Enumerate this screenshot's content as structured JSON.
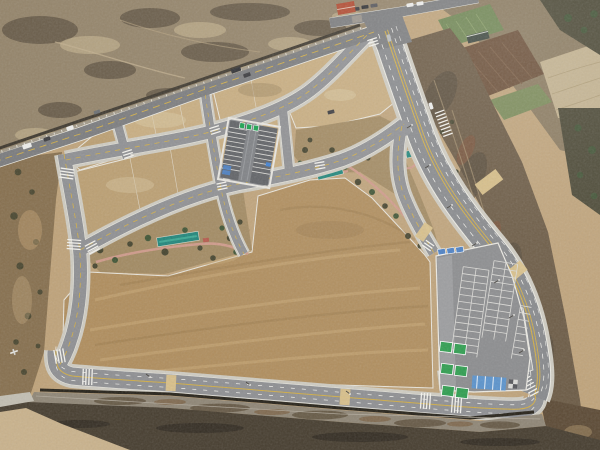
{
  "scene": {
    "description": "Winter aerial drone photo of a newly graded land-development district: bare tan earth lots outlined by fresh concrete-gray roads, a central sunken parking bay, a large surface parking lot with green EV stalls and blue accessible stalls, linear pocket parks with pink walking paths and teal shade structures, an existing boundary road with traffic at upper left, farm fields and wooded slopes at upper right, and a dark rock-faced retaining wall along the bottom edge.",
    "palette": {
      "base": "#bfa37a",
      "lotLight": "#c8ad80",
      "lotMid": "#bb9f72",
      "bigLot": "#b08e5e",
      "streakLight": "#dbbd8a",
      "streakDark": "#8a6b40",
      "scrubNW": "#94846a",
      "scrubSW": "#87704f",
      "scrubDark": "#554939",
      "scrubLight": "#cbb992",
      "slopeEast": "#6b5a44",
      "slopeRed": "#7d5238",
      "slopeLight": "#a5906e",
      "woods": "#4a4734",
      "treeDark": "#45442e",
      "treeGreen": "#3f5434",
      "fieldGreen": "#6f8653",
      "fieldBrown": "#6b4f38",
      "fieldPale": "#c2b18e",
      "fieldStripe": "#7a8a58",
      "roadNew": "#8f9093",
      "roadOld": "#7b7c7e",
      "roadArterial": "#87898c",
      "sidewalk": "#cfccc2",
      "rimWhite": "#ecebe4",
      "curb": "#e9e6dd",
      "lineWhite": "#f4f3ee",
      "lineYellow": "#d2ae46",
      "paverTan": "#dcc28b",
      "parkGround": "#a28a62",
      "pathPink": "#cf9a8a",
      "teal": "#1f857a",
      "tealLight": "#39a893",
      "p1Asphalt": "#5f6165",
      "p1Aisle": "#7e8084",
      "stallWhite": "#dcdbd7",
      "signGreen": "#17a04c",
      "signBlue": "#3f7fd0",
      "hcBlue": "#4a7fc4",
      "evGreen": "#2f9e50",
      "blueStripe": "#5b93cc",
      "p2Asphalt": "#8b8c8e",
      "p2Aisle": "#9b9c9e",
      "gabion": "#8f8676",
      "wallDark": "#473e30",
      "wallShadow": "#262219",
      "wallLine": "#b3ab9d",
      "bottomTan": "#c9b28c",
      "carWhite": "#eeeeec",
      "carDark": "#3a3a3e",
      "carSilver": "#b8bcc0",
      "truckDark": "#2f3033",
      "bldgRed": "#b14a30",
      "bldgGray": "#9a948c",
      "shedDark": "#3c463e",
      "wallStone": "#a29a8a",
      "postWhite": "#e8e4da"
    },
    "features": {
      "roads": [
        "existing boundary road",
        "top frontage road",
        "eastern arterial",
        "south perimeter road",
        "west collector",
        "two diagonal collectors",
        "three block connectors",
        "park-edge loop road"
      ],
      "parking_central_bay": {
        "stall_rows": 2,
        "green_signs": 3,
        "blue_signs": 2,
        "accessible_stalls": 2
      },
      "parking_se_lot": {
        "stall_banks": 3,
        "ev_stalls": 6,
        "accessible_stalls": 3,
        "blue_striped_zone": 1
      },
      "crossings": {
        "zebra_crosswalks": 12,
        "tan_paver_crossings": 5
      },
      "parks": {
        "pocket_parks": 2,
        "teal_shelters": 3,
        "pink_paths": 4
      },
      "vehicles": {
        "count": 14
      },
      "buildings": {
        "red_roof": 1,
        "gray": 1,
        "farm_shed": 1
      }
    }
  }
}
